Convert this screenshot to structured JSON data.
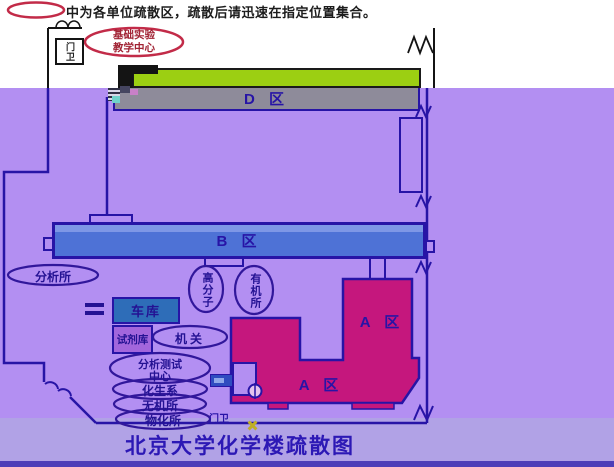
{
  "legend": {
    "note": "中为各单位疏散区，疏散后请迅速在指定位置集合。"
  },
  "title": "北京大学化学楼疏散图",
  "zones": {
    "d": {
      "label": "D 区"
    },
    "b": {
      "label": "B 区"
    },
    "a_upper": {
      "label": "A 区"
    },
    "a_lower": {
      "label": "A 区"
    }
  },
  "gates": {
    "top": "门卫",
    "bottom": "门卫"
  },
  "buildings": {
    "garage": "车库",
    "reagent_store": "试剂库"
  },
  "units": {
    "base_teaching_center": {
      "line1": "基础实验",
      "line2": "教学中心"
    },
    "analysis_institute": "分析所",
    "polymer": "高分子",
    "organic_institute": "有机所",
    "admin_office": "机关",
    "analysis_test_center": {
      "line1": "分析测试",
      "line2": "中心"
    },
    "chem_bio_dept": "化生系",
    "inorganic_institute": "无机所",
    "phys_chem_institute": "物化所"
  },
  "colors": {
    "background_purple": "#b38ff2",
    "bottom_band": "#b1a2e6",
    "bottom_strip": "#4d3eb8",
    "zone_d_green": "#9ccf12",
    "zone_d_gray": "#8e8b9a",
    "zone_b_blue": "#4e72d6",
    "zone_a_magenta": "#c5177d",
    "garage_blue": "#2e6db8",
    "reagent_violet": "#a266dc",
    "wall_blue": "#2714a6",
    "oval_red": "#c22b48",
    "text_navy": "#241293",
    "title_blue": "#2c18b5"
  }
}
